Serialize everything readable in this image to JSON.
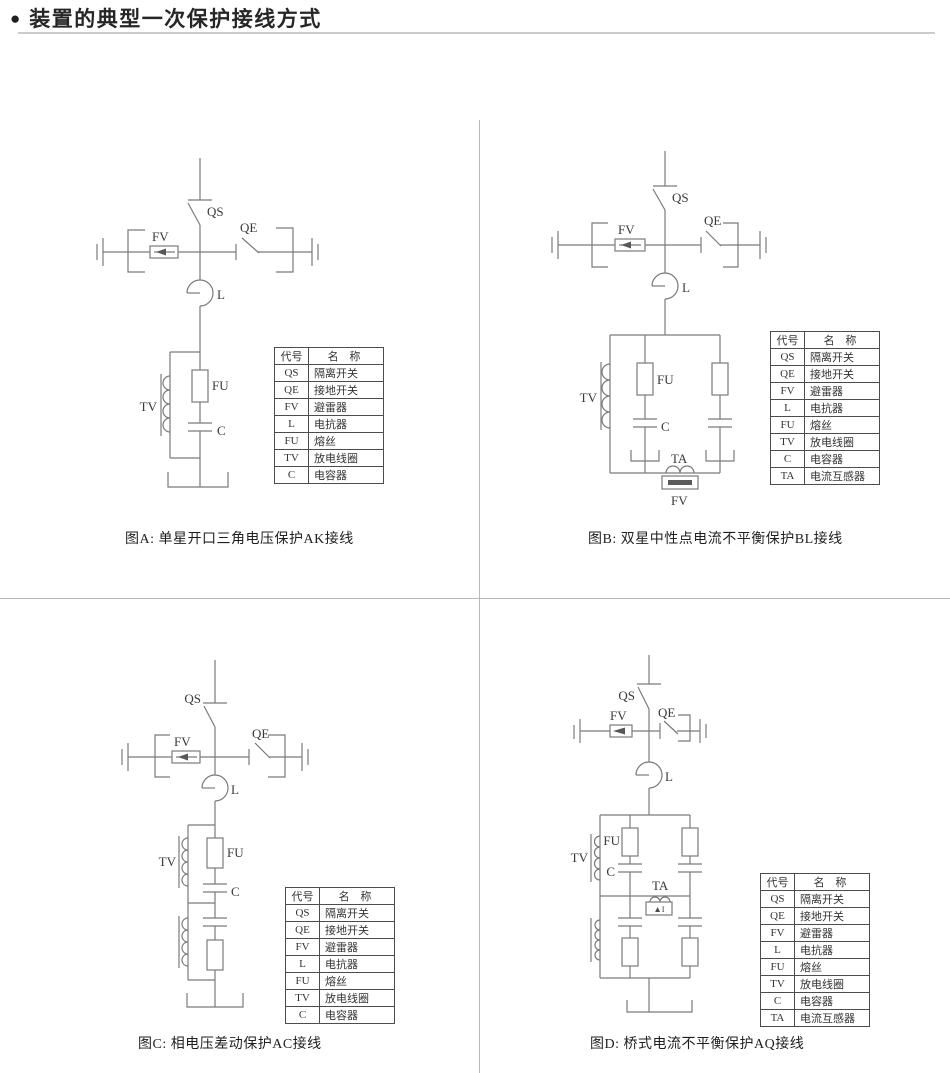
{
  "page": {
    "bullet": "●",
    "title": "装置的典型一次保护接线方式"
  },
  "labels": {
    "qs": "QS",
    "qe": "QE",
    "fv": "FV",
    "l": "L",
    "fu": "FU",
    "tv": "TV",
    "c": "C",
    "ta": "TA",
    "delta_i": "▲I"
  },
  "legend_header": {
    "code": "代号",
    "name": "名 称"
  },
  "legend7": {
    "rows": [
      [
        "QS",
        "隔离开关"
      ],
      [
        "QE",
        "接地开关"
      ],
      [
        "FV",
        "避雷器"
      ],
      [
        "L",
        "电抗器"
      ],
      [
        "FU",
        "熔丝"
      ],
      [
        "TV",
        "放电线圈"
      ],
      [
        "C",
        "电容器"
      ]
    ]
  },
  "legend8": {
    "rows": [
      [
        "QS",
        "隔离开关"
      ],
      [
        "QE",
        "接地开关"
      ],
      [
        "FV",
        "避雷器"
      ],
      [
        "L",
        "电抗器"
      ],
      [
        "FU",
        "熔丝"
      ],
      [
        "TV",
        "放电线圈"
      ],
      [
        "C",
        "电容器"
      ],
      [
        "TA",
        "电流互感器"
      ]
    ]
  },
  "figures": {
    "a": {
      "caption": "图A: 单星开口三角电压保护AK接线"
    },
    "b": {
      "caption": "图B: 双星中性点电流不平衡保护BL接线"
    },
    "c": {
      "caption": "图C: 相电压差动保护AC接线"
    },
    "d": {
      "caption": "图D: 桥式电流不平衡保护AQ接线"
    }
  }
}
